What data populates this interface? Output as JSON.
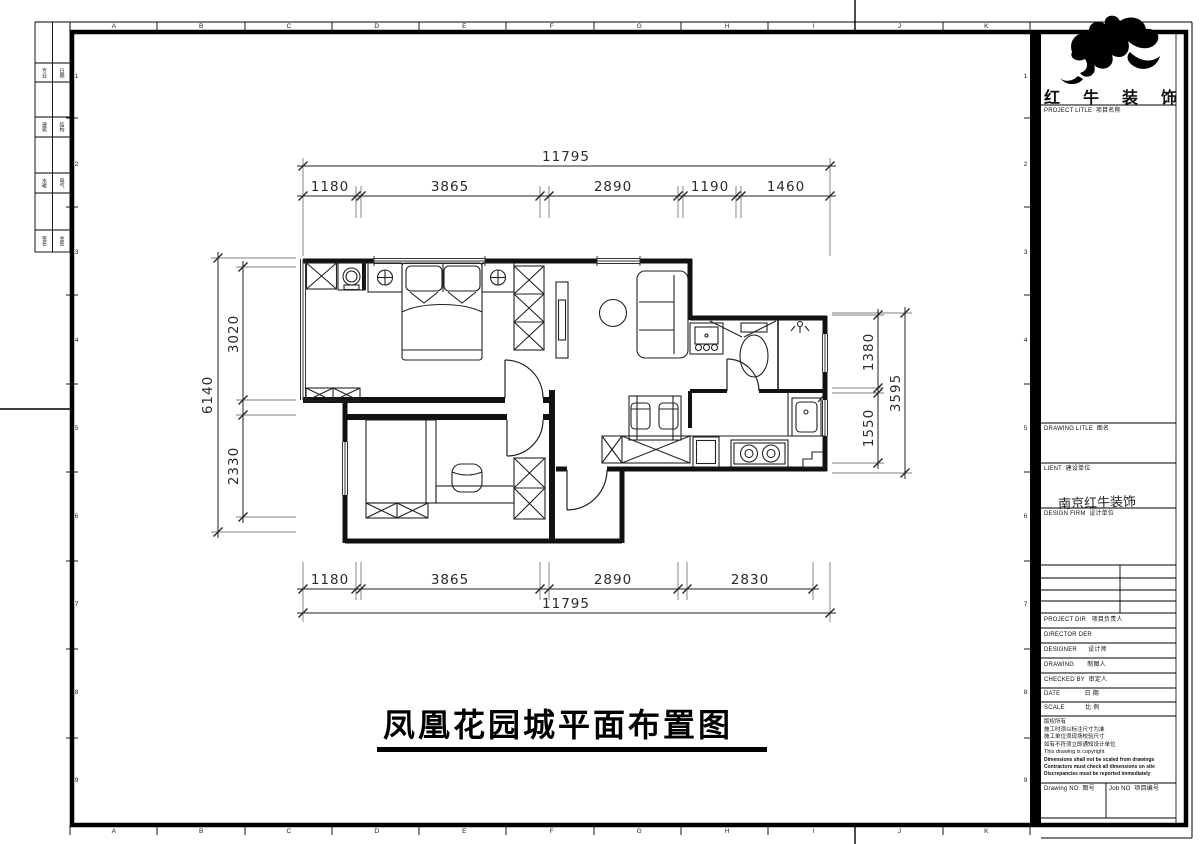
{
  "sheet": {
    "grid_letters": [
      "A",
      "B",
      "C",
      "D",
      "E",
      "F",
      "G",
      "H",
      "I",
      "J",
      "K"
    ],
    "grid_numbers": [
      "1",
      "2",
      "3",
      "4",
      "5",
      "6",
      "7",
      "8",
      "9"
    ],
    "margin_rows": [
      [
        "专业",
        "日期"
      ],
      [
        "建筑",
        "结构"
      ],
      [
        "水暖",
        "电气"
      ],
      [
        "签名",
        "会签"
      ]
    ]
  },
  "title_block": {
    "brand": [
      "红",
      "牛",
      "装",
      "饰"
    ],
    "project_title_label": "PROJECT LITLE  项目名称",
    "drawing_title_label": "DRAWING LITLE  图名",
    "client_label": "LIENT  建设单位",
    "design_firm_label": "DESIGN FIRM  设计单位",
    "design_firm_value": "南京红牛装饰",
    "project_dir_label": "PROJECT DIR   项目负责人",
    "director_label": "DIRECTOR DER",
    "designer_label": "DESIGNER      设计师",
    "drawing_by_label": "DRAWING       制图人",
    "checked_by_label": "CHECKED BY  审定人",
    "date_label": "DATE             日 期",
    "scale_label": "SCALE           比 例",
    "copyright_lines": [
      "版权所有",
      "施工时须以标注尺寸为准",
      "施工单位须现场校验尺寸",
      "如有不符须立即通知设计单位",
      "This drawing is copyright"
    ],
    "copyright_bold_lines": [
      "Dimensions shall not be scaled from drawings",
      "Contractors must check all dimensions on site",
      "Discrepancies must be reported immediately"
    ],
    "drawing_no_label": "Drawing NO  图号",
    "job_no_label": "Job NO  项目编号"
  },
  "drawing": {
    "title": "凤凰花园城平面布置图",
    "dimensions": {
      "top_total": "11795",
      "top_segments": [
        "1180",
        "3865",
        "2890",
        "1190",
        "1460"
      ],
      "bottom_total": "11795",
      "bottom_segments": [
        "1180",
        "3865",
        "2890",
        "2830"
      ],
      "left_total": "6140",
      "left_segments": [
        "3020",
        "2330"
      ],
      "right_total": "3595",
      "right_segments": [
        "1380",
        "1550"
      ]
    }
  }
}
